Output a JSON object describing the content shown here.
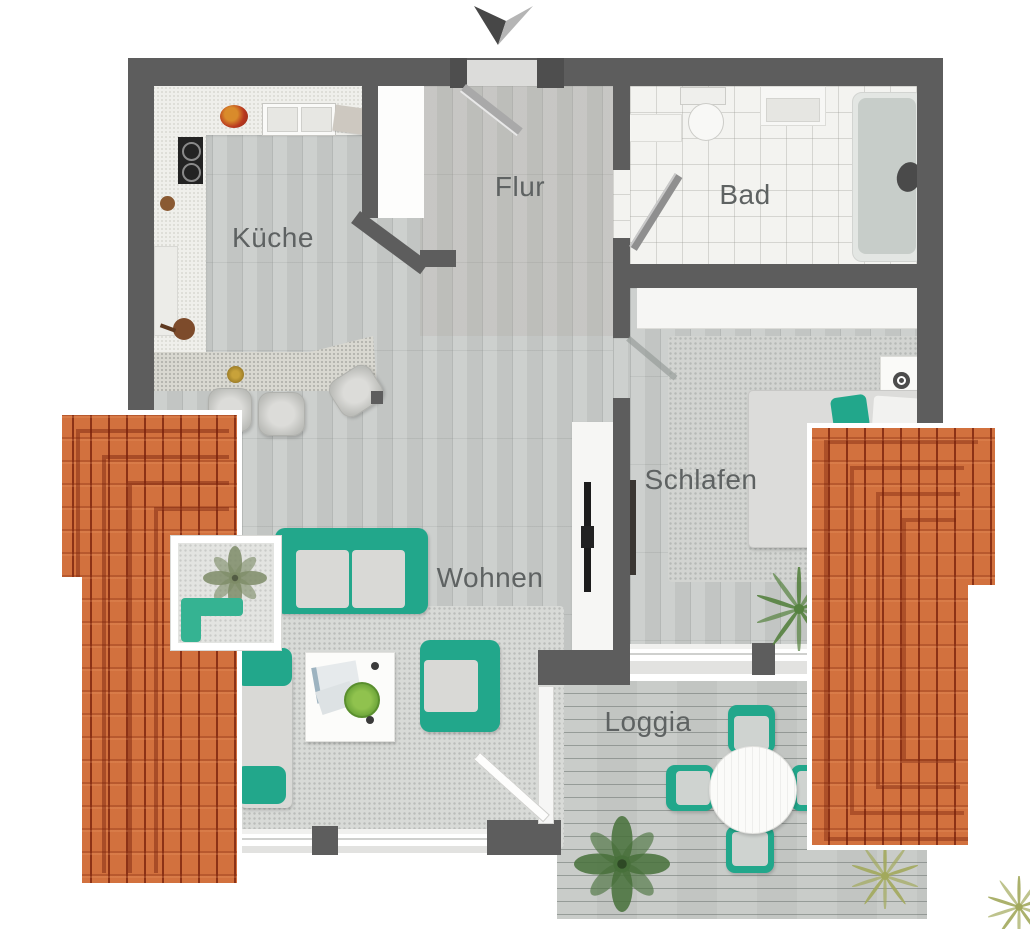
{
  "title": "Apartment floor plan",
  "compass": {
    "icon": "north-arrow",
    "direction": "south-pointing"
  },
  "rooms": {
    "kueche": {
      "label": "Küche"
    },
    "flur": {
      "label": "Flur"
    },
    "bad": {
      "label": "Bad"
    },
    "schlafen": {
      "label": "Schlafen"
    },
    "wohnen": {
      "label": "Wohnen"
    },
    "loggia": {
      "label": "Loggia"
    }
  },
  "furniture": {
    "kueche": [
      "kitchen-counter",
      "cooktop",
      "double-sink",
      "fruit-bowl",
      "breakfast-bar",
      "bar-stools"
    ],
    "bad": [
      "bathtub",
      "toilet",
      "vanity-sink",
      "cabinet",
      "bath-door"
    ],
    "schlafen": [
      "double-bed",
      "pillows",
      "nightstand",
      "wardrobe",
      "tv-panel",
      "palm-plant"
    ],
    "wohnen": [
      "two-seat-sofa",
      "wall-sofa",
      "armchair",
      "coffee-table",
      "tv-sideboard",
      "rug",
      "dormer-skylight",
      "plant"
    ],
    "loggia": [
      "round-table",
      "four-chairs",
      "leaf-plant",
      "grass-plants",
      "wood-decking"
    ]
  },
  "colors": {
    "wall": "#5d5d5d",
    "roof_tile": "#d2713e",
    "roof_ridge": "#8d3a1d",
    "accent_teal": "#22a78b",
    "wood_floor": "#c9ccca",
    "bath_tile": "#f3f3f0",
    "deck": "#c6c9c6",
    "label_text": "#5e6262"
  }
}
